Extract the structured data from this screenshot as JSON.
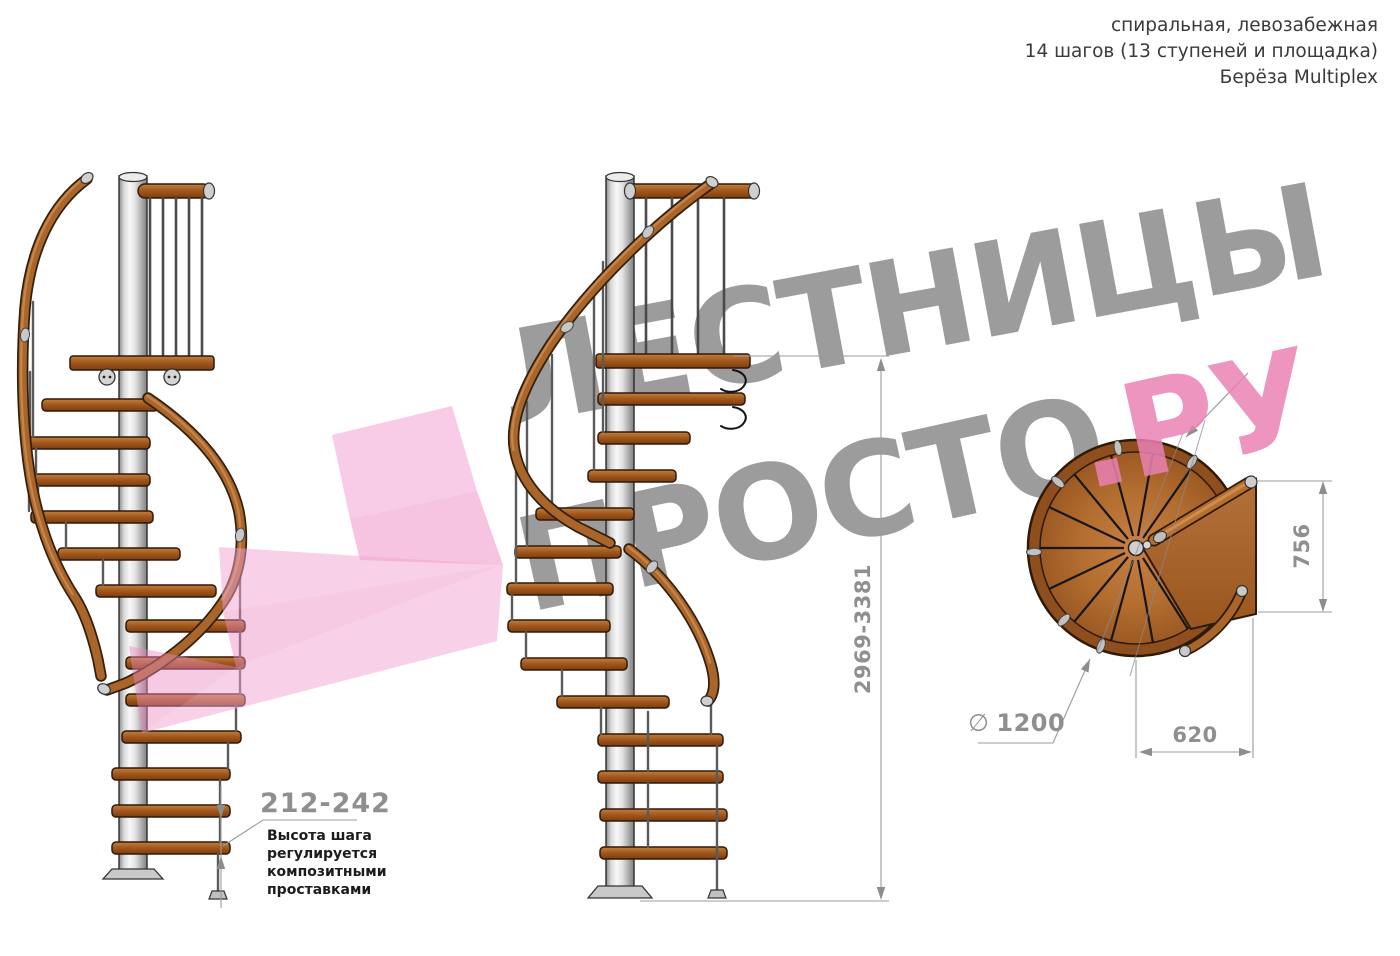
{
  "header": {
    "line1": "спиральная, левозабежная",
    "line2": "14 шагов (13 ступеней и площадка)",
    "line3": "Берёза Multiplex"
  },
  "watermark": {
    "word_top": "ЛЕСТНИЦЫ",
    "word_bottom_gray": "ПРОСТО",
    "word_bottom_pink": ".РУ"
  },
  "dimensions": {
    "total_height": "2969-3381",
    "landing_side": "756",
    "landing_width": "620",
    "diameter_symbol": "∅",
    "diameter_value": "1200",
    "step_height": "212-242"
  },
  "note": {
    "lines": [
      "Высота шага",
      "регулируется",
      "композитными",
      "проставками"
    ]
  },
  "colors": {
    "wood_mid": "#a9652a",
    "wood_dark": "#33200c",
    "wood_plan": "#b26d2f",
    "metal_light": "#e8e8e8",
    "dimension_gray": "#8f8f8f",
    "watermark_gray": "#9c9c9c",
    "watermark_pink": "#ea82b4",
    "arrow_pink": "#ef8cc4"
  }
}
